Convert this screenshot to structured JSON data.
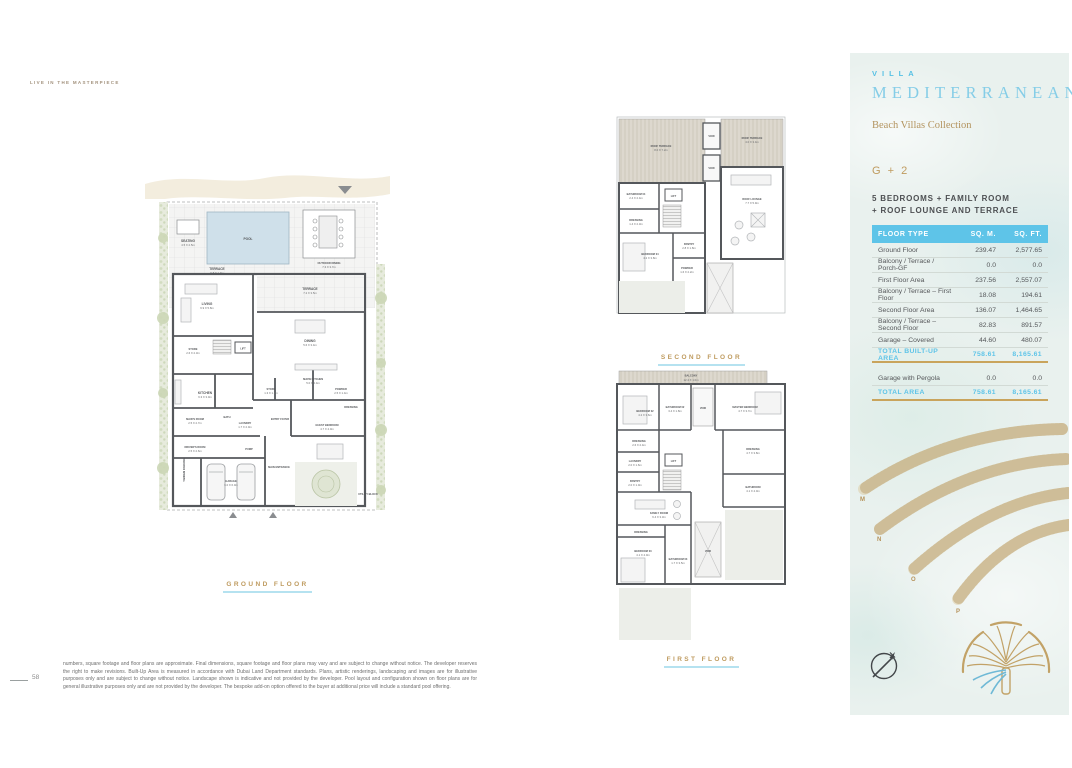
{
  "page": {
    "eyebrow": "LIVE IN THE MASTERPIECE",
    "page_number": "58",
    "disclaimer": "numbers, square footage and floor plans are approximate. Final dimensions, square footage and floor plans may vary and are subject to change without notice. The developer reserves the right to make revisions. Built-Up Area is measured in accordance with Dubai Land Department standards. Plans, artistic renderings, landscaping and images are for illustrative purposes only and are subject to change without notice. Landscape shown is indicative and not provided by the developer. Pool layout and configuration shown on floor plans are for general illustrative purposes only and are not provided by the developer. The bespoke add-on option offered to the buyer at additional price will include a standard pool offering."
  },
  "panel": {
    "villa": "VILLA",
    "name": "MEDITERRANEAN",
    "collection": "Beach Villas Collection",
    "unit_type": "G + 2",
    "subtitle_line1": "5 BEDROOMS + FAMILY ROOM",
    "subtitle_line2": "+ ROOF LOUNGE AND TERRACE",
    "table": {
      "col_floor_type": "FLOOR TYPE",
      "col_sqm": "SQ. M.",
      "col_sqft": "SQ. FT.",
      "rows": [
        {
          "label": "Ground Floor",
          "sqm": "239.47",
          "sqft": "2,577.65"
        },
        {
          "label": "Balcony / Terrace / Porch-GF",
          "sqm": "0.0",
          "sqft": "0.0"
        },
        {
          "label": "First Floor Area",
          "sqm": "237.56",
          "sqft": "2,557.07"
        },
        {
          "label": "Balcony / Terrace – First Floor",
          "sqm": "18.08",
          "sqft": "194.61"
        },
        {
          "label": "Second Floor Area",
          "sqm": "136.07",
          "sqft": "1,464.65"
        },
        {
          "label": "Balcony / Terrace – Second Floor",
          "sqm": "82.83",
          "sqft": "891.57"
        },
        {
          "label": "Garage – Covered",
          "sqm": "44.60",
          "sqft": "480.07"
        }
      ],
      "total_built_up": {
        "label": "TOTAL BUILT-UP AREA",
        "sqm": "758.61",
        "sqft": "8,165.61"
      },
      "garage_pergola": {
        "label": "Garage with Pergola",
        "sqm": "0.0",
        "sqft": "0.0"
      },
      "total": {
        "label": "TOTAL AREA",
        "sqm": "758.61",
        "sqft": "8,165.61"
      }
    },
    "fronds": {
      "m": "M",
      "n": "N",
      "o": "O",
      "p": "P"
    },
    "colors": {
      "accent_blue": "#5ec4e8",
      "title_blue": "#85cde7",
      "gold": "#bf9b5f",
      "underline_blue": "#b5e2f0",
      "panel_bg": "#e9f1ee"
    }
  },
  "plans": {
    "ground": {
      "label": "GROUND FLOOR",
      "rooms": {
        "seating": {
          "n": "SEATING",
          "d": "4.5 X 2.5m"
        },
        "pool": {
          "n": "POOL"
        },
        "outdoor_dining": {
          "n": "OUTDOOR DINING",
          "d": "7.3 X 3.7m"
        },
        "terrace1": {
          "n": "TERRACE",
          "d": "6.8 X 1.9m"
        },
        "terrace2": {
          "n": "TERRACE",
          "d": "7.2 X 3.5m"
        },
        "living": {
          "n": "LIVING",
          "d": "6.9 X 5.8m"
        },
        "dining": {
          "n": "DINING",
          "d": "5.6 X 3.4m"
        },
        "store1": {
          "n": "STORE",
          "d": "2.6 X 2.3m"
        },
        "lift": {
          "n": "LIFT"
        },
        "show_kitchen": {
          "n": "SHOW KITCHEN",
          "d": "5.0 X 2.4m"
        },
        "kitchen": {
          "n": "KITCHEN",
          "d": "6.3 X 3.0m"
        },
        "store2": {
          "n": "STORE",
          "d": "1.3 X 1.3m"
        },
        "powder": {
          "n": "POWDER",
          "d": "2.5 X 1.4m"
        },
        "maids_room": {
          "n": "MAID'S ROOM",
          "d": "2.5 X 2.7m"
        },
        "bath": {
          "n": "BATH"
        },
        "laundry": {
          "n": "LAUNDRY",
          "d": "1.7 X 2.0m"
        },
        "dressing": {
          "n": "DRESSING"
        },
        "drivers_room": {
          "n": "DRIVER'S ROOM",
          "d": "2.5 X 2.6m"
        },
        "pump": {
          "n": "PUMP"
        },
        "entry_foyer": {
          "n": "ENTRY FOYER"
        },
        "guest_bedroom": {
          "n": "GUEST BEDROOM",
          "d": "4.7 X 4.0m"
        },
        "garage": {
          "n": "GARAGE",
          "d": "6.0 X 6.0m"
        },
        "main_entrance": {
          "n": "MAIN ENTRANCE"
        },
        "tandem_parking": {
          "n": "TANDEM PARKING"
        },
        "utility_block": {
          "n": "UTILITY BLOCK"
        }
      }
    },
    "second": {
      "label": "SECOND FLOOR",
      "rooms": {
        "roof_terrace1": {
          "n": "ROOF TERRACE",
          "d": "8.0 X 7.2m"
        },
        "roof_terrace2": {
          "n": "ROOF TERRACE",
          "d": "4.0 X 3.4m"
        },
        "void1": {
          "n": "VOID"
        },
        "void2": {
          "n": "VOID"
        },
        "roof_lounge": {
          "n": "ROOF LOUNGE",
          "d": "7.7 X 5.9m"
        },
        "bathroom04": {
          "n": "BATHROOM 04",
          "d": "2.4 X 2.4m"
        },
        "dressing": {
          "n": "DRESSING",
          "d": "1.4 X 2.3m"
        },
        "lift": {
          "n": "LIFT"
        },
        "bedroom04": {
          "n": "BEDROOM 04",
          "d": "4.2 X 3.8m"
        },
        "pantry": {
          "n": "PANTRY",
          "d": "2.8 X 1.8m"
        },
        "powder": {
          "n": "POWDER",
          "d": "1.6 X 2.2m"
        }
      }
    },
    "first": {
      "label": "FIRST FLOOR",
      "rooms": {
        "balcony": {
          "n": "BALCONY",
          "d": "12.4 X 1.0m"
        },
        "bedroom02": {
          "n": "BEDROOM 02",
          "d": "4.2 X 3.6m"
        },
        "bathroom02": {
          "n": "BATHROOM 02",
          "d": "3.4 X 1.8m"
        },
        "void1": {
          "n": "VOID"
        },
        "master_bedroom": {
          "n": "MASTER BEDROOM",
          "d": "4.7 X 3.7m"
        },
        "dressing1": {
          "n": "DRESSING",
          "d": "2.6 X 2.4m"
        },
        "laundry": {
          "n": "LAUNDRY",
          "d": "2.0 X 1.6m"
        },
        "pantry": {
          "n": "PANTRY",
          "d": "2.0 X 1.0m"
        },
        "lift": {
          "n": "LIFT"
        },
        "dressing2": {
          "n": "DRESSING",
          "d": "4.7 X 3.8m"
        },
        "bathroom": {
          "n": "BATHROOM",
          "d": "4.1 X 4.0m"
        },
        "family_room": {
          "n": "FAMILY ROOM",
          "d": "6.4 X 3.3m"
        },
        "dressing3": {
          "n": "DRESSING"
        },
        "bedroom03": {
          "n": "BEDROOM 03",
          "d": "4.1 X 4.0m"
        },
        "bathroom03": {
          "n": "BATHROOM 03",
          "d": "1.7 X 3.5m"
        },
        "void2": {
          "n": "VOID"
        }
      }
    }
  }
}
